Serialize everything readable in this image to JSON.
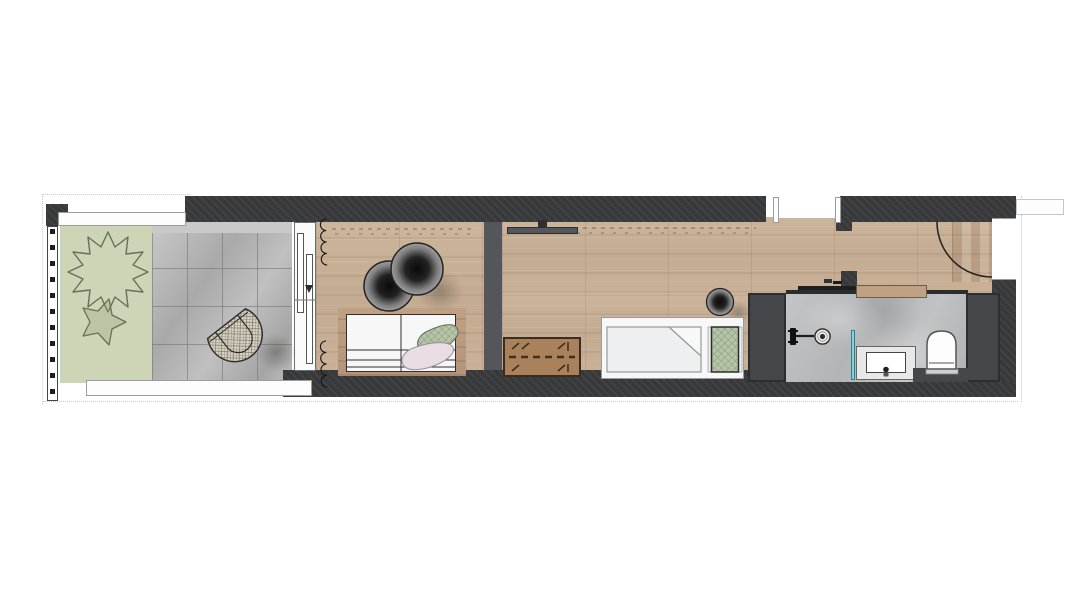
{
  "meta": {
    "type": "architectural-floor-plan",
    "view": "top-down rendered plan",
    "description": "long narrow studio apartment with balcony, bedroom, living hall and bathroom"
  },
  "palette": {
    "wall-base": "#38393b",
    "shaft": "#45464a",
    "wood-base": "#cdb59c",
    "wood-dark-base": "#c0a184",
    "green": "#ccd5b5",
    "tile-base": "#b7b7b7",
    "marble-base": "#c3c5c7",
    "passage": "#55565b",
    "glass": "#7fd4da",
    "brown": "#a9815b",
    "bed-white": "#f7f7f7",
    "pillow-green": "#b5c3a6",
    "throw-pink": "#e9dde4",
    "pouf-dark": "#0a0a0a",
    "plant-stroke": "#66705e",
    "line-dark": "#262626"
  },
  "rooms": {
    "balcony": {
      "name": "balcony — lawn and stone tile patio"
    },
    "bedroom": {
      "name": "bedroom — oak plank floor"
    },
    "hall": {
      "name": "living hall — oak plank floor"
    },
    "bathroom": {
      "name": "bathroom — grey marble floor"
    }
  },
  "furniture": {
    "railing": "balcony railing",
    "column": "structural column",
    "plant": "balcony shrub",
    "lounge_chair": "round rattan lounge chair",
    "window": "sliding glass balcony door",
    "curtains": "curtain coils",
    "poufs": "two round dark poufs / side tables",
    "double_bed": "double bed with pillows and throw blanket",
    "tv": "wall mounted tv",
    "folding_table": "wooden folding table",
    "daybed": "daybed with duvet and checkered cushion",
    "small_pouf": "round pouf",
    "niche": "wall niche opening",
    "entry_door": "entry door with swing arc",
    "sliding_door": "bathroom sliding door",
    "shower": "rain shower with mixer and floor drain",
    "glass_screen": "shower glass screen",
    "vanity": "vanity with basin",
    "toilet": "toilet",
    "shaft_left": "service shaft",
    "shaft_right": "service shaft"
  }
}
